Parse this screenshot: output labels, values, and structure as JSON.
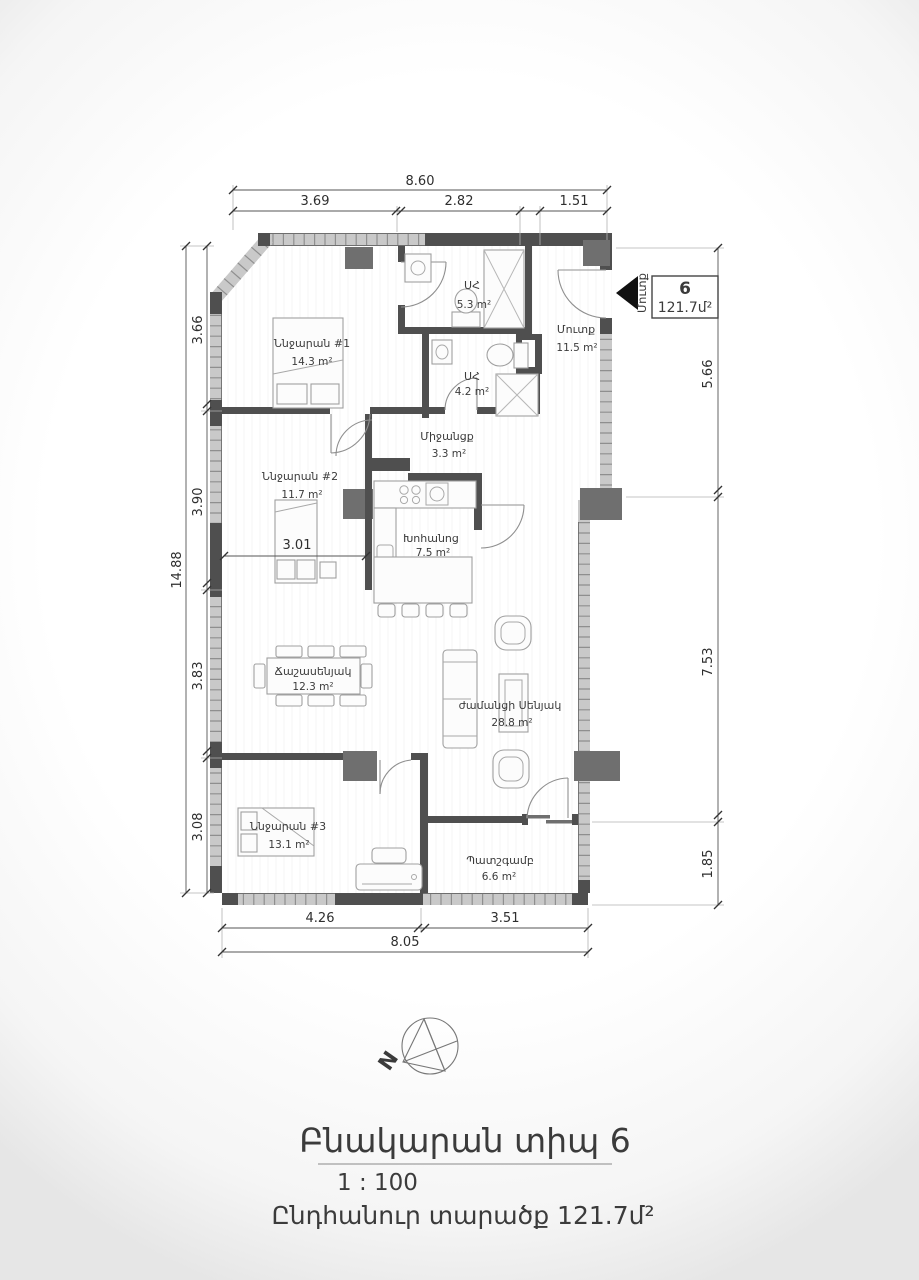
{
  "unit_tag": {
    "number": "6",
    "area": "121.7մ²",
    "entrance": "Մուտք"
  },
  "rooms": {
    "bedroom1": {
      "label": "Ննջարան #1",
      "area": "14.3 m²"
    },
    "bath1": {
      "label": "ՍՀ",
      "area": "5.3 m²"
    },
    "bath2": {
      "label": "ՍՀ",
      "area": "4.2 m²"
    },
    "entrance": {
      "label": "Մուտք",
      "area": "11.5 m²"
    },
    "corridor": {
      "label": "Միջանցք",
      "area": "3.3 m²"
    },
    "bedroom2": {
      "label": "Ննջարան #2",
      "area": "11.7 m²"
    },
    "kitchen": {
      "label": "Խոհանոց",
      "area": "7.5 m²"
    },
    "dining": {
      "label": "Ճաշասենյակ",
      "area": "12.3 m²"
    },
    "living": {
      "label": "ժամանցի Սենյակ",
      "area": "28.8 m²"
    },
    "bedroom3": {
      "label": "Ննջարան #3",
      "area": "13.1 m²"
    },
    "balcony": {
      "label": "Պատշգամբ",
      "area": "6.6 m²"
    }
  },
  "dimensions": {
    "top_total": "8.60",
    "top_segments": [
      "3.69",
      "2.82",
      "1.51"
    ],
    "left_total": "14.88",
    "left_segments": [
      "3.66",
      "3.90",
      "3.83",
      "3.08"
    ],
    "right_segments": [
      "5.66",
      "7.53",
      "1.85"
    ],
    "bottom_segments": [
      "4.26",
      "3.51"
    ],
    "bottom_total": "8.05",
    "bedroom2_width": "3.01"
  },
  "compass": {
    "north": "N"
  },
  "footer": {
    "title": "Բնակարան տիպ 6",
    "scale": "1 : 100",
    "total_area": "Ընդհանուր տարածք 121.7մ²"
  }
}
